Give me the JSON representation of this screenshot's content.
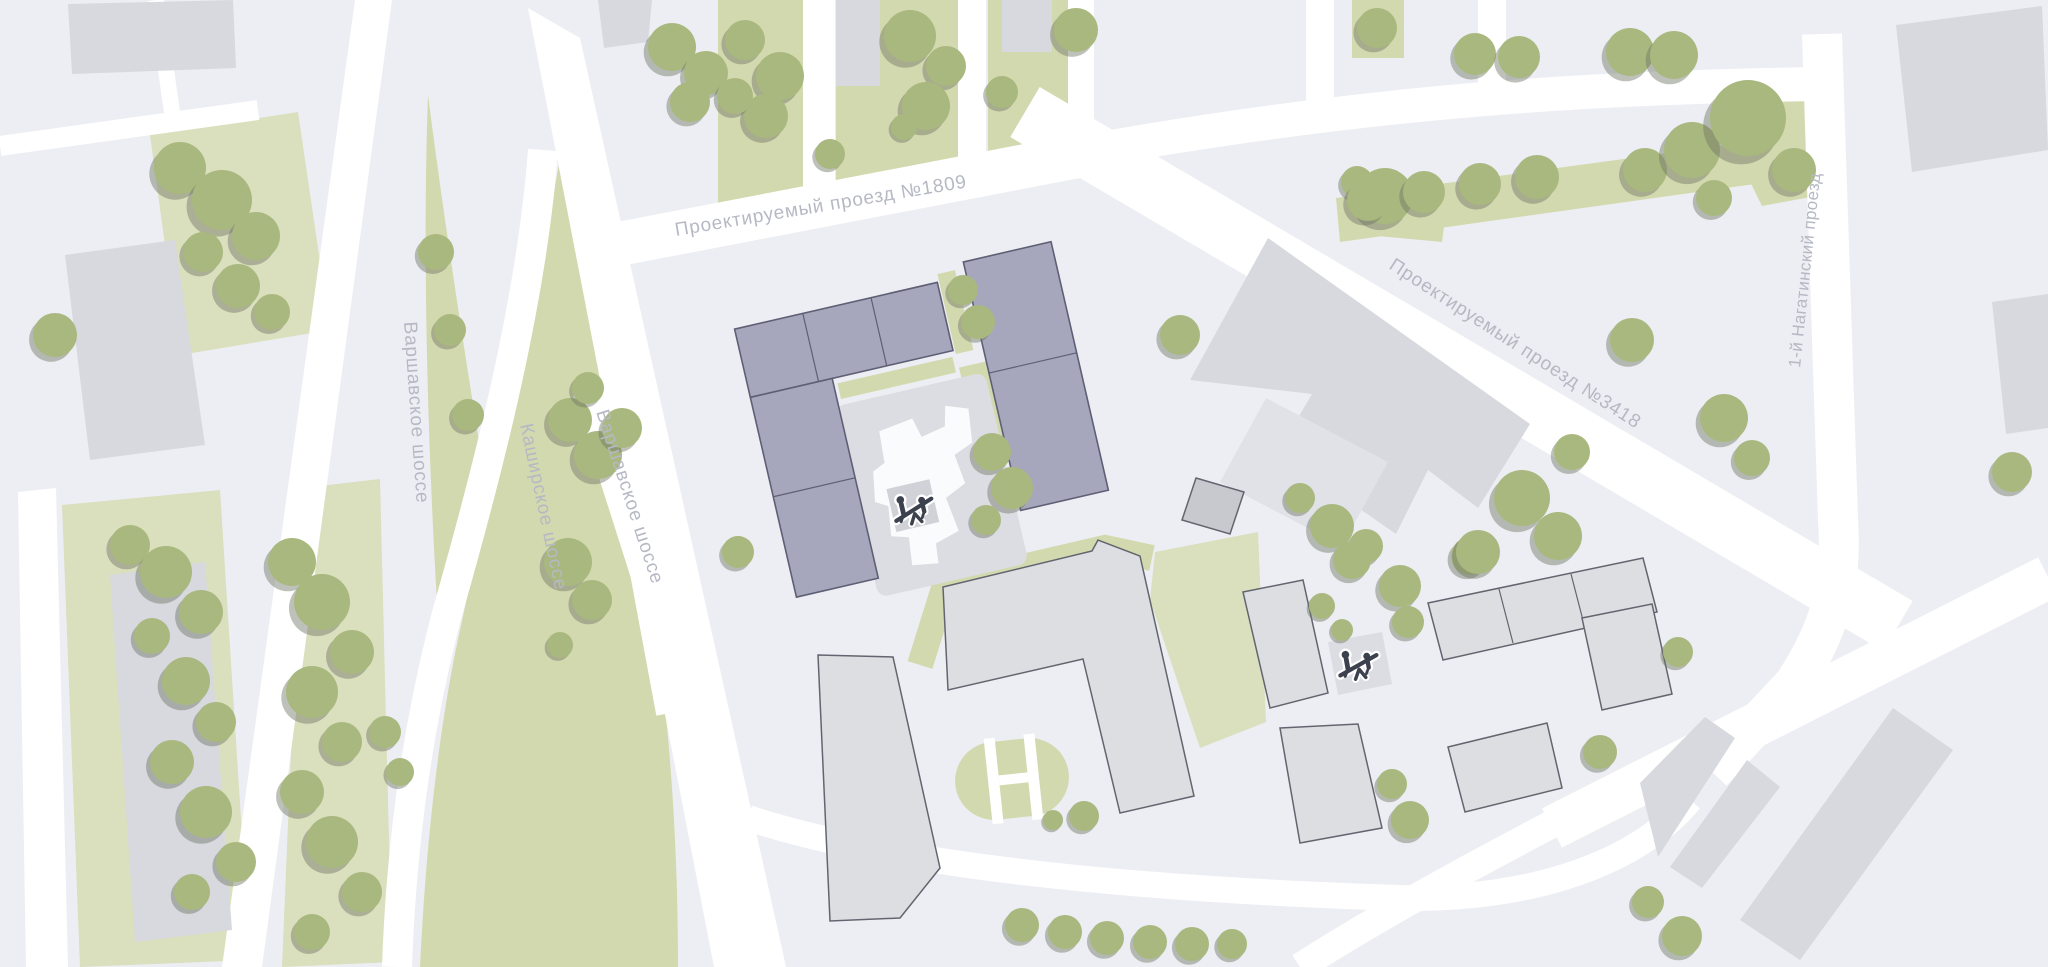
{
  "map": {
    "streets": [
      {
        "id": "proezd-1809",
        "text": "Проектируемый проезд №1809"
      },
      {
        "id": "varshavskoe-1",
        "text": "Варшавское шоссе"
      },
      {
        "id": "kashirskoe",
        "text": "Каширское шоссе"
      },
      {
        "id": "varshavskoe-2",
        "text": "Варшавское шоссе"
      },
      {
        "id": "proezd-3418",
        "text": "Проектируемый проезд №3418"
      },
      {
        "id": "nagatinsky",
        "text": "1-й Нагатинский проезд"
      }
    ],
    "icons": [
      {
        "name": "playground-seesaw-icon",
        "location": "featured-courtyard"
      },
      {
        "name": "playground-seesaw-icon",
        "location": "east-yard"
      }
    ],
    "palette": {
      "bg": "#edeef3",
      "road": "#ffffff",
      "green": "#d3d9ae",
      "green-light": "#dadfbd",
      "tree": "#a9b87e",
      "tree-shadow": "#6e7565",
      "bldg": "#d7d9de",
      "bldg-light": "#e0e2e7",
      "bldg-dark": "#c7c9cf",
      "bldg-out": "#dcdee2",
      "outline": "#62656f",
      "purple": "#a6a7bc",
      "purple-stroke": "#5e5f74",
      "pad": "#dcdde2",
      "pad-dark": "#d0d2d8",
      "blob": "#fafbfd",
      "label": "#b6b9c4",
      "icon-dark": "#3c414e"
    },
    "trees": [
      [
        55,
        335,
        22
      ],
      [
        180,
        168,
        26
      ],
      [
        222,
        200,
        30
      ],
      [
        256,
        236,
        24
      ],
      [
        203,
        252,
        20
      ],
      [
        238,
        286,
        22
      ],
      [
        272,
        312,
        18
      ],
      [
        130,
        545,
        20
      ],
      [
        166,
        572,
        26
      ],
      [
        201,
        612,
        22
      ],
      [
        152,
        636,
        18
      ],
      [
        186,
        681,
        24
      ],
      [
        216,
        722,
        20
      ],
      [
        172,
        762,
        22
      ],
      [
        206,
        812,
        26
      ],
      [
        236,
        862,
        20
      ],
      [
        192,
        892,
        18
      ],
      [
        292,
        562,
        24
      ],
      [
        322,
        602,
        28
      ],
      [
        352,
        652,
        22
      ],
      [
        312,
        692,
        26
      ],
      [
        342,
        742,
        20
      ],
      [
        302,
        792,
        22
      ],
      [
        332,
        842,
        26
      ],
      [
        362,
        892,
        20
      ],
      [
        312,
        932,
        18
      ],
      [
        385,
        732,
        16
      ],
      [
        400,
        772,
        14
      ],
      [
        436,
        252,
        18
      ],
      [
        450,
        330,
        16
      ],
      [
        468,
        415,
        16
      ],
      [
        570,
        420,
        22
      ],
      [
        598,
        455,
        24
      ],
      [
        622,
        428,
        20
      ],
      [
        588,
        388,
        16
      ],
      [
        672,
        47,
        24
      ],
      [
        706,
        73,
        22
      ],
      [
        690,
        102,
        20
      ],
      [
        745,
        40,
        20
      ],
      [
        780,
        76,
        24
      ],
      [
        766,
        116,
        22
      ],
      [
        735,
        96,
        18
      ],
      [
        910,
        36,
        26
      ],
      [
        946,
        66,
        20
      ],
      [
        926,
        106,
        24
      ],
      [
        1076,
        30,
        22
      ],
      [
        1002,
        92,
        16
      ],
      [
        830,
        154,
        15
      ],
      [
        904,
        127,
        13
      ],
      [
        963,
        290,
        15
      ],
      [
        978,
        322,
        17
      ],
      [
        992,
        452,
        19
      ],
      [
        1012,
        488,
        21
      ],
      [
        986,
        520,
        15
      ],
      [
        738,
        552,
        16
      ],
      [
        568,
        562,
        24
      ],
      [
        592,
        600,
        20
      ],
      [
        560,
        645,
        13
      ],
      [
        1180,
        335,
        20
      ],
      [
        1385,
        196,
        28
      ],
      [
        1357,
        182,
        16
      ],
      [
        1300,
        498,
        15
      ],
      [
        1332,
        526,
        22
      ],
      [
        1366,
        546,
        17
      ],
      [
        1470,
        556,
        19
      ],
      [
        1522,
        498,
        28
      ],
      [
        1558,
        536,
        24
      ],
      [
        1632,
        340,
        22
      ],
      [
        1572,
        452,
        18
      ],
      [
        1352,
        560,
        19
      ],
      [
        1400,
        586,
        21
      ],
      [
        1408,
        622,
        16
      ],
      [
        1322,
        606,
        13
      ],
      [
        1342,
        630,
        11
      ],
      [
        1478,
        552,
        22
      ],
      [
        1678,
        652,
        15
      ],
      [
        1600,
        752,
        17
      ],
      [
        1392,
        784,
        15
      ],
      [
        1410,
        820,
        19
      ],
      [
        1648,
        902,
        16
      ],
      [
        1682,
        936,
        20
      ],
      [
        1724,
        418,
        24
      ],
      [
        1752,
        458,
        18
      ],
      [
        2012,
        472,
        20
      ],
      [
        1645,
        170,
        22
      ],
      [
        1692,
        150,
        28
      ],
      [
        1748,
        118,
        38
      ],
      [
        1794,
        170,
        22
      ],
      [
        1714,
        198,
        18
      ],
      [
        1368,
        200,
        21
      ],
      [
        1424,
        192,
        21
      ],
      [
        1480,
        184,
        21
      ],
      [
        1537,
        177,
        22
      ],
      [
        1475,
        54,
        21
      ],
      [
        1519,
        57,
        21
      ],
      [
        1630,
        52,
        24
      ],
      [
        1674,
        55,
        24
      ],
      [
        1377,
        28,
        20
      ],
      [
        1022,
        925,
        17
      ],
      [
        1065,
        932,
        17
      ],
      [
        1107,
        938,
        17
      ],
      [
        1150,
        942,
        17
      ],
      [
        1192,
        944,
        17
      ],
      [
        1232,
        944,
        15
      ],
      [
        1053,
        820,
        10
      ],
      [
        1084,
        816,
        15
      ]
    ]
  }
}
